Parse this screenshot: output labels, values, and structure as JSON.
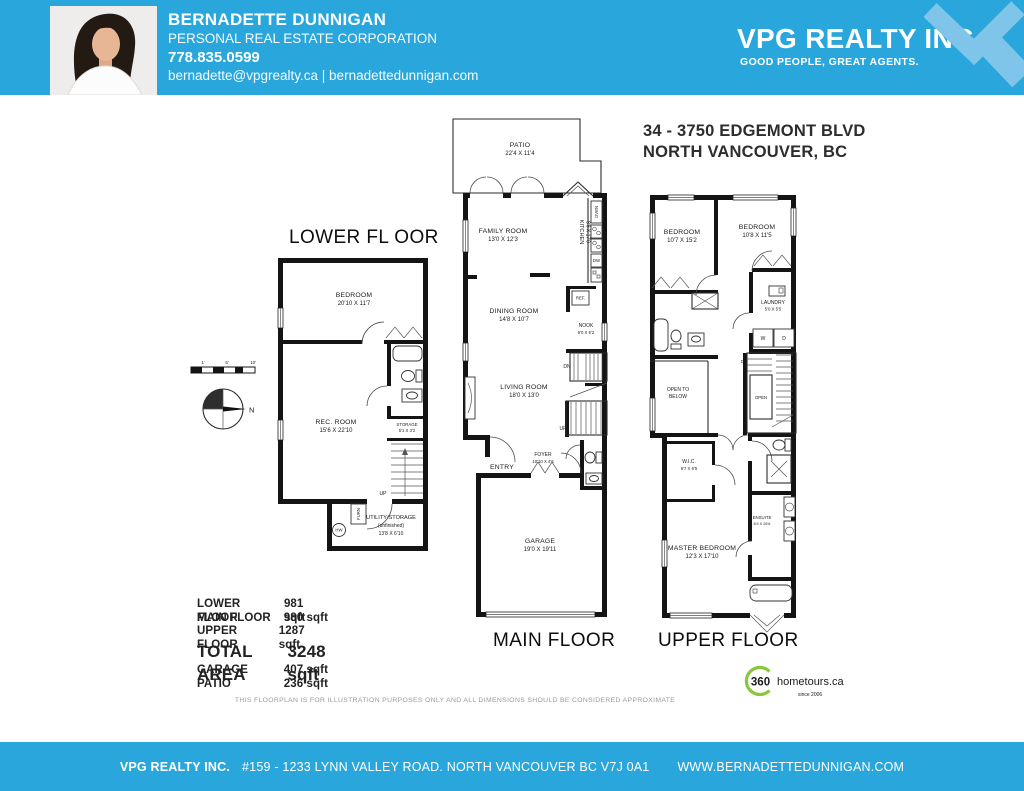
{
  "header": {
    "agent_name": "BERNADETTE DUNNIGAN",
    "agent_title": "PERSONAL REAL ESTATE CORPORATION",
    "agent_phone": "778.835.0599",
    "agent_contact": "bernadette@vpgrealty.ca | bernadettedunnigan.com",
    "brand_name": "VPG REALTY INC.",
    "brand_tagline": "GOOD PEOPLE, GREAT AGENTS.",
    "bar_color": "#29a7dc",
    "logo_color": "#7ec5e9"
  },
  "listing": {
    "address_line1": "34 - 3750 EDGEMONT BLVD",
    "address_line2": "NORTH VANCOUVER, BC"
  },
  "lower": {
    "title": "LOWER FL OOR",
    "bedroom_name": "BEDROOM",
    "bedroom_dims": "20'10 X 11'7",
    "rec_name": "REC. ROOM",
    "rec_dims": "15'6 X 22'10",
    "storage_name": "STORAGE",
    "storage_dims": "5'1 X 3'2",
    "utility_name": "UTILITY/STORAGE",
    "utility_note": "(unfinished)",
    "utility_dims": "13'8 X 6'10",
    "up": "UP",
    "furn": "FURN",
    "hw": "HW"
  },
  "main": {
    "title": "MAIN FLOOR",
    "patio_name": "PATIO",
    "patio_dims": "22'4 X 11'4",
    "family_name": "FAMILY ROOM",
    "family_dims": "13'0 X 12'3",
    "kitchen_name": "KITCHEN",
    "kitchen_dims": "8'8 X 17'0",
    "dining_name": "DINING ROOM",
    "dining_dims": "14'8 X 10'7",
    "nook_name": "NOOK",
    "nook_dims": "6'0 X 6'2",
    "living_name": "LIVING ROOM",
    "living_dims": "18'0 X 13'0",
    "foyer_name": "FOYER",
    "foyer_dims": "10'10 X 4'6",
    "garage_name": "GARAGE",
    "garage_dims": "19'0 X 19'11",
    "entry": "ENTRY",
    "ref": "REF.",
    "oven": "OVEN",
    "dw": "DW",
    "dn": "DN",
    "up": "UP"
  },
  "upper": {
    "title": "UPPER FLOOR",
    "bedroom2_name": "BEDROOM",
    "bedroom2_dims": "10'7 X 15'2",
    "bedroom3_name": "BEDROOM",
    "bedroom3_dims": "10'8 X 11'5",
    "laundry_name": "LAUNDRY",
    "laundry_dims": "5'0 X 5'5",
    "open_below_1": "OPEN TO",
    "open_below_2": "BELOW",
    "open": "OPEN",
    "dn": "DN",
    "wic_name": "W.I.C.",
    "wic_dims": "6'7 X 6'5",
    "ensuite_name": "ENSUITE",
    "ensuite_dims": "6'4 X 26'6",
    "master_name": "MASTER BEDROOM",
    "master_dims": "12'3 X 17'10",
    "washer": "W",
    "dryer": "D"
  },
  "scale": {
    "tick1": "1'",
    "tick5": "5'",
    "tick10": "10'",
    "north": "N"
  },
  "areas": {
    "rows": [
      {
        "label": "LOWER FLOOR",
        "value": "981 sqft"
      },
      {
        "label": "MAIN FLOOR",
        "value": "980 sqft"
      },
      {
        "label": "UPPER FLOOR",
        "value": "1287 sqft"
      }
    ],
    "total_label": "TOTAL AREA",
    "total_value": "3248 sqft",
    "extra_rows": [
      {
        "label": "GARAGE",
        "value": "407 sqft"
      },
      {
        "label": "PATIO",
        "value": "236 sqft"
      }
    ]
  },
  "disclaimer": "THIS FLOORPLAN IS FOR ILLUSTRATION PURPOSES ONLY AND ALL DIMENSIONS SHOULD BE CONSIDERED APPROXIMATE",
  "tour": {
    "number": "360",
    "name": "hometours.ca",
    "since": "since 2006",
    "green": "#8cc63e"
  },
  "footer": {
    "brand": "VPG REALTY INC.",
    "address": "#159 - 1233 LYNN VALLEY ROAD.  NORTH VANCOUVER BC  V7J 0A1",
    "website": "WWW.BERNADETTEDUNNIGAN.COM"
  }
}
